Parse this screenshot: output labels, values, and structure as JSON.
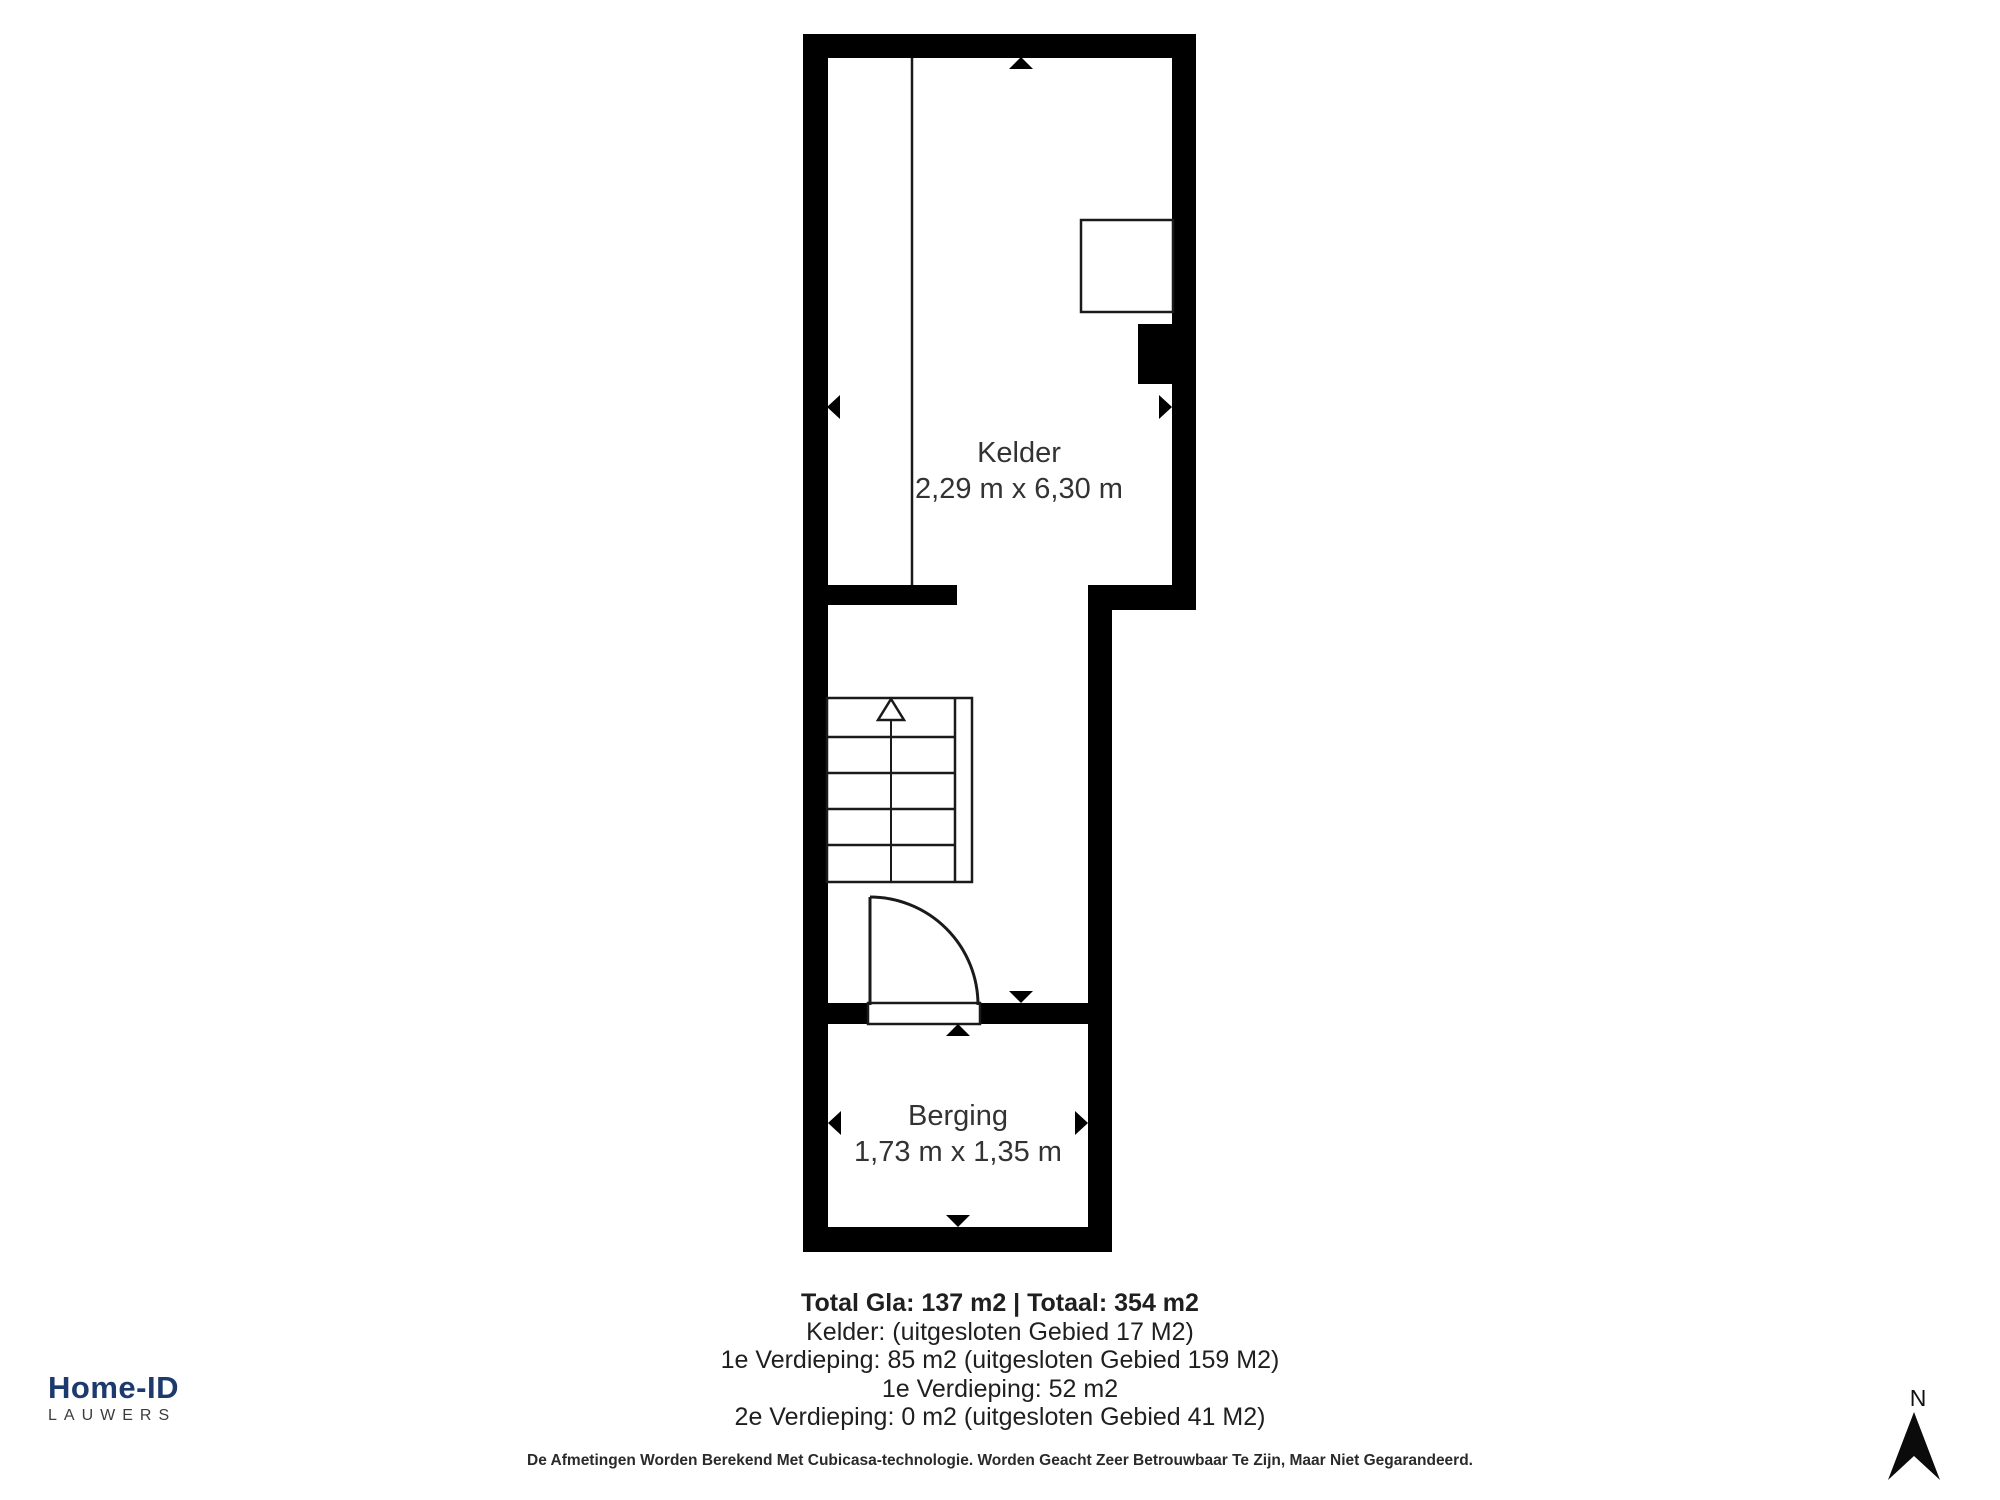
{
  "plan": {
    "rooms": [
      {
        "name": "Kelder",
        "dimensions": "2,29 m x 6,30 m"
      },
      {
        "name": "Berging",
        "dimensions": "1,73 m x 1,35 m"
      }
    ]
  },
  "summary": {
    "total": "Total Gla: 137 m2 | Totaal: 354 m2",
    "lines": [
      "Kelder: (uitgesloten Gebied 17 M2)",
      "1e Verdieping: 85 m2 (uitgesloten Gebied 159 M2)",
      "1e Verdieping: 52 m2",
      "2e Verdieping: 0 m2 (uitgesloten Gebied 41 M2)"
    ]
  },
  "disclaimer": "De Afmetingen Worden Berekend Met Cubicasa-technologie. Worden Geacht Zeer Betrouwbaar Te Zijn, Maar Niet Gegarandeerd.",
  "branding": {
    "name": "Home-ID",
    "subtitle": "LAUWERS"
  },
  "compass": {
    "north_label": "N"
  },
  "colors": {
    "wall": "#000000",
    "line": "#1a1a1a",
    "logo_primary": "#1d3a6e",
    "logo_secondary": "#3c3c3c",
    "room_label_text": "#333333",
    "summary_text": "#1f1f1f"
  }
}
